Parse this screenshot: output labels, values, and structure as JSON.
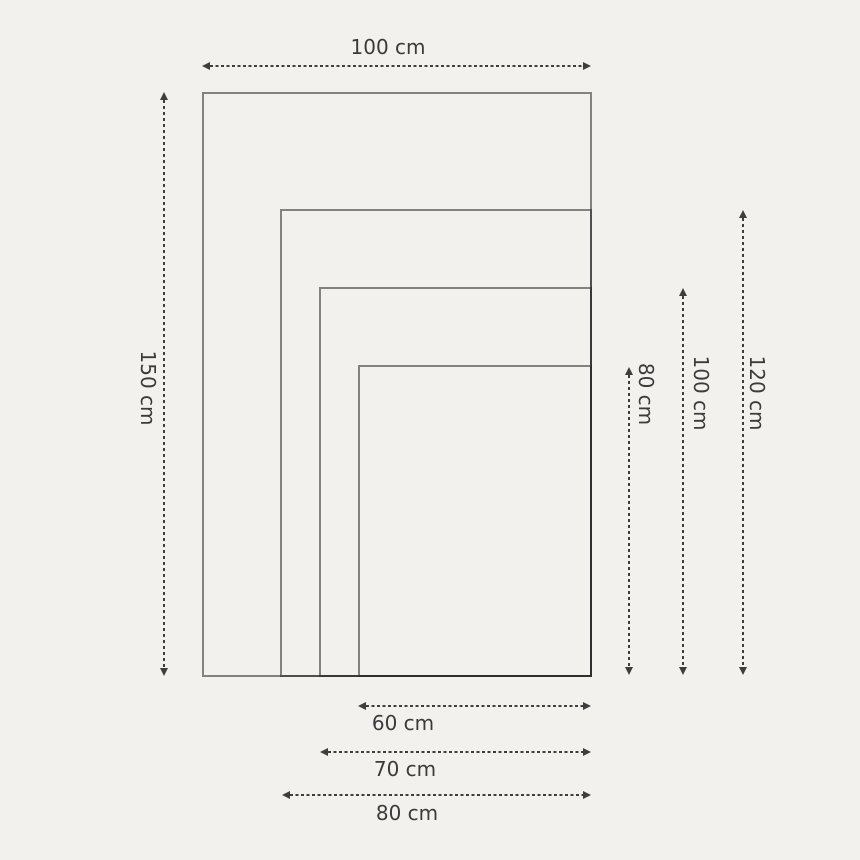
{
  "diagram": {
    "type": "nested-size-comparison",
    "unit": "cm",
    "sizes": [
      {
        "name": "100x150",
        "width_cm": 100,
        "height_cm": 150
      },
      {
        "name": "80x120",
        "width_cm": 80,
        "height_cm": 120
      },
      {
        "name": "70x100",
        "width_cm": 70,
        "height_cm": 100
      },
      {
        "name": "60x80",
        "width_cm": 60,
        "height_cm": 80
      }
    ],
    "labels": {
      "top_width": "100 cm",
      "left_height": "150 cm",
      "right_height_80": "80 cm",
      "right_height_100": "100 cm",
      "right_height_120": "120 cm",
      "bottom_width_60": "60 cm",
      "bottom_width_70": "70 cm",
      "bottom_width_80": "80 cm"
    },
    "colors": {
      "background": "#f2f1ee",
      "rect_stroke_single": "#838383",
      "rect_stroke_overlap": "#2c2c2c",
      "arrow": "#3e3e3e",
      "text": "#3b3b3b"
    }
  }
}
